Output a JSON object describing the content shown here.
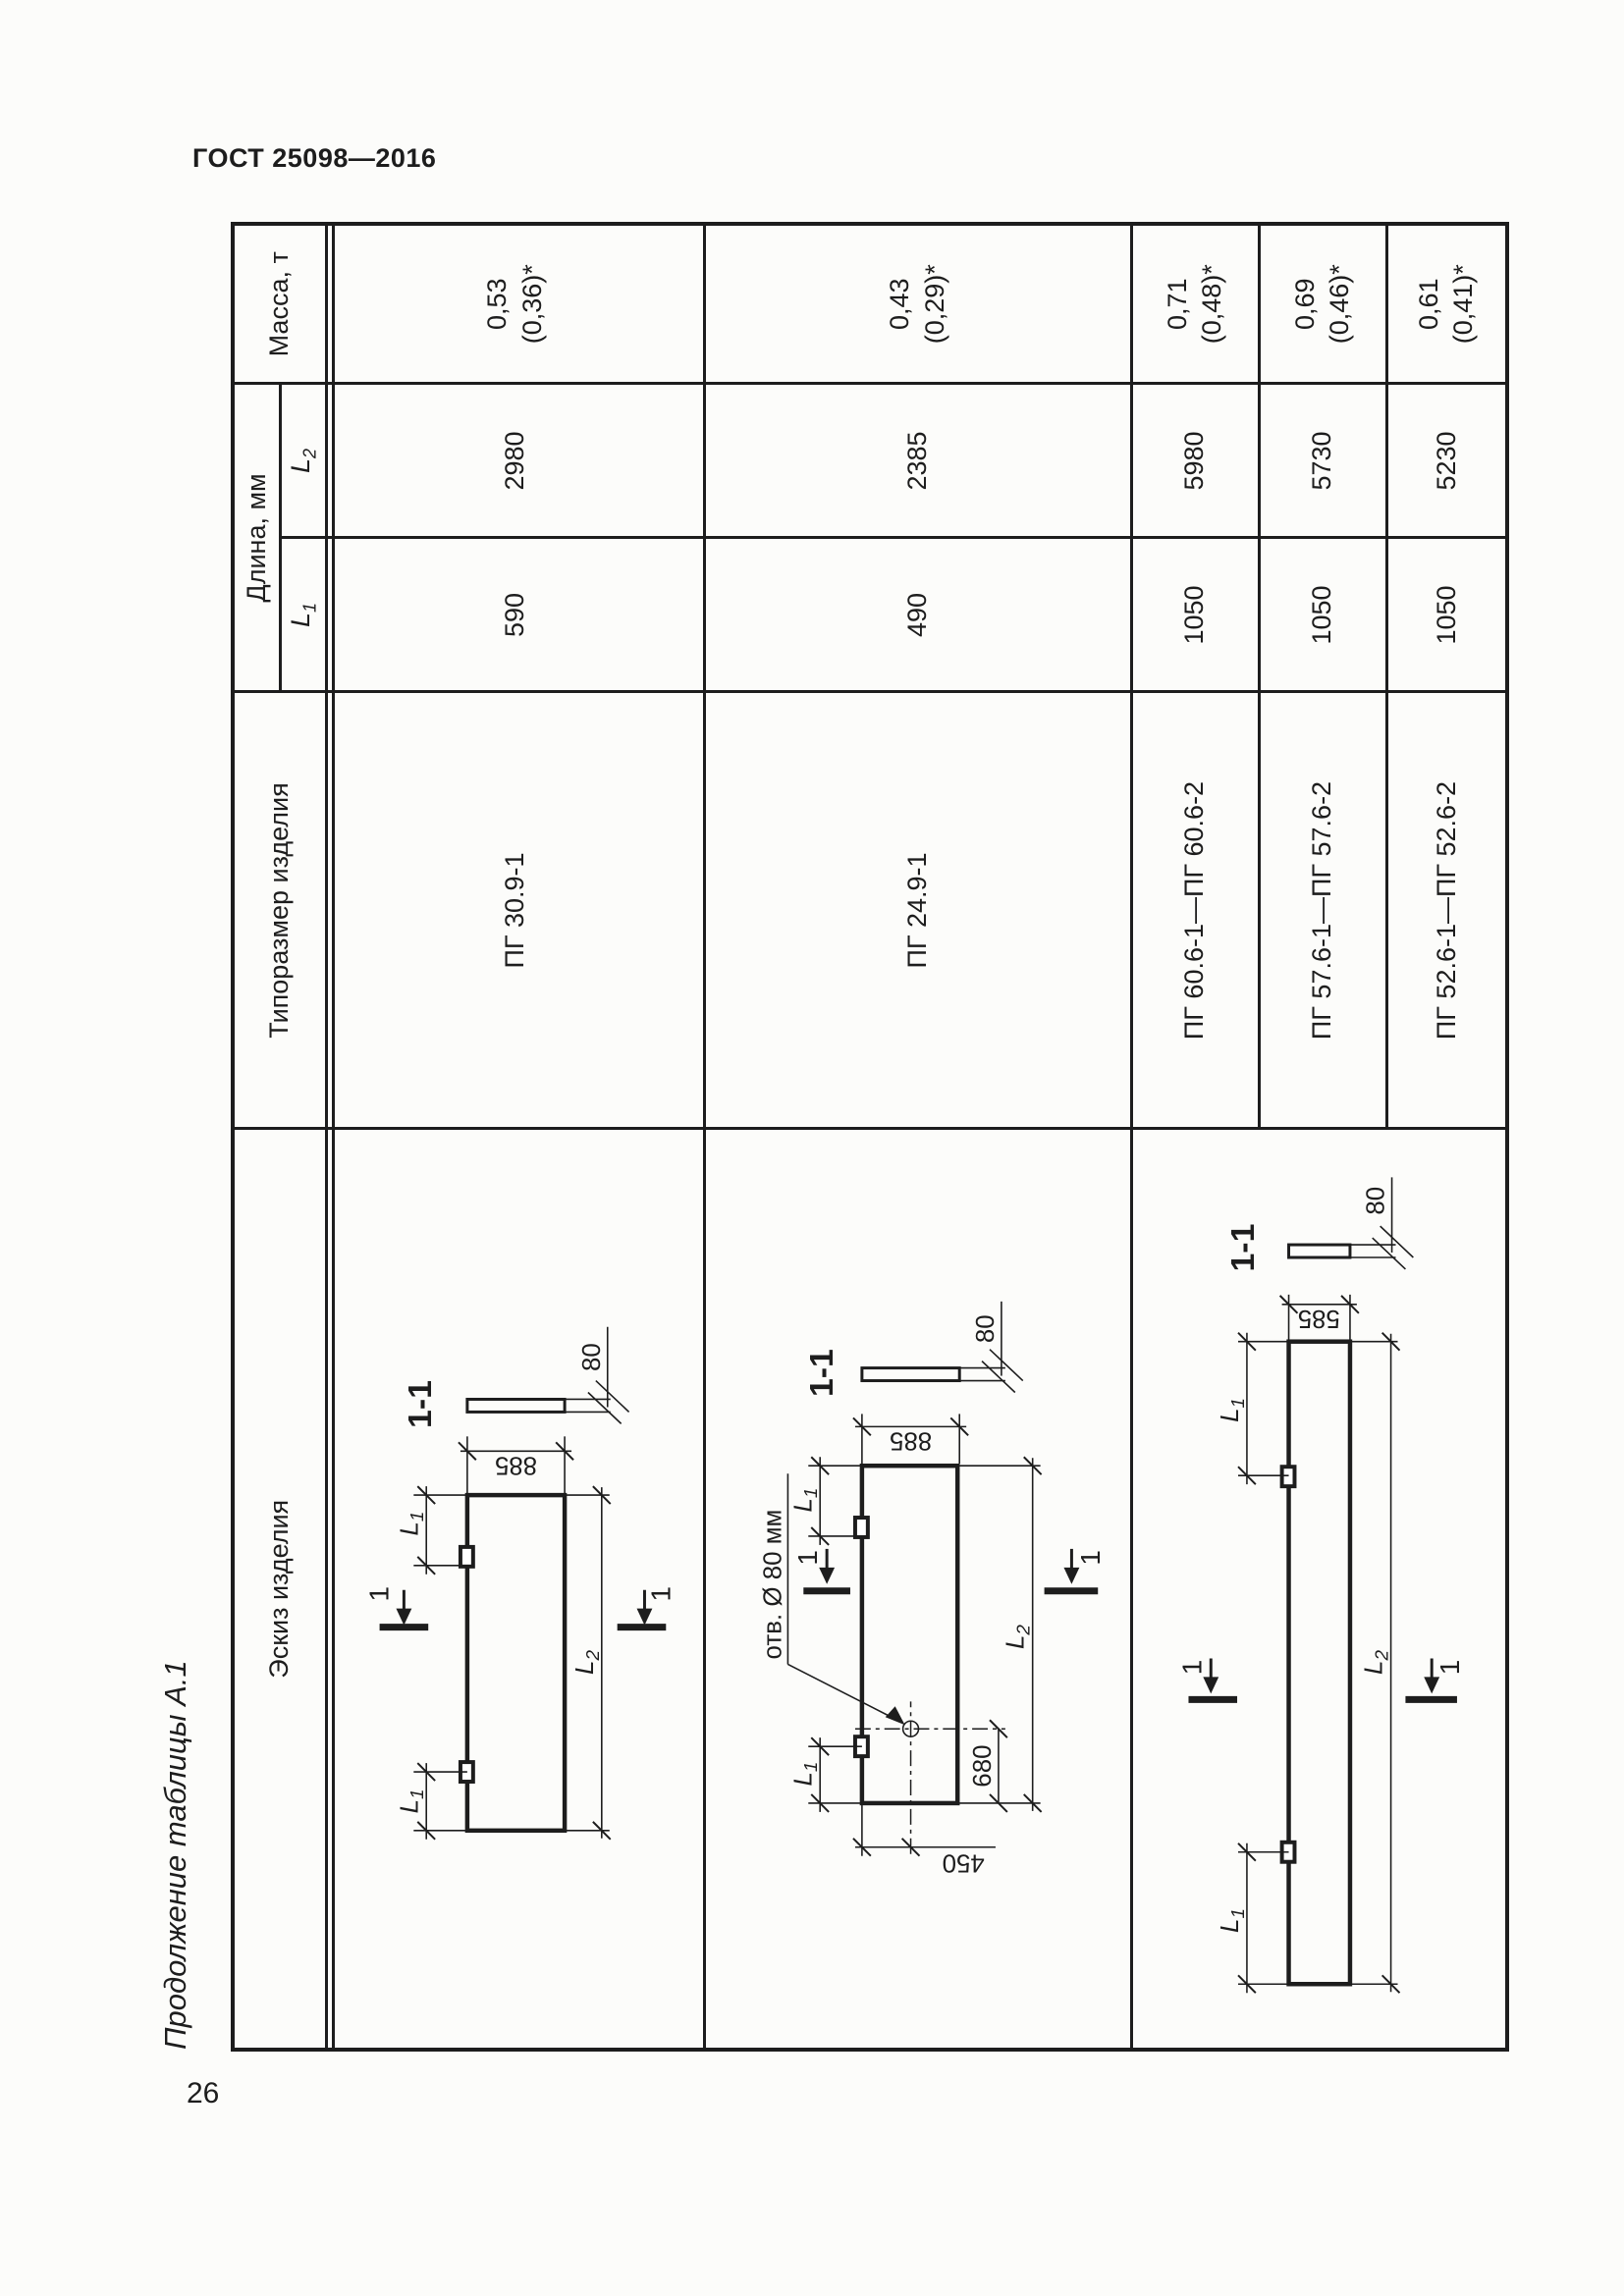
{
  "page": {
    "standard": "ГОСТ 25098—2016",
    "page_number": "26",
    "table_caption": "Продолжение таблицы А.1"
  },
  "table": {
    "headers": {
      "sketch": "Эскиз изделия",
      "type": "Типоразмер изделия",
      "length": "Длина, мм",
      "l1": {
        "base": "L",
        "sub": "1"
      },
      "l2": {
        "base": "L",
        "sub": "2"
      },
      "mass": "Масса, т"
    },
    "rows": [
      {
        "type": "ПГ 30.9-1",
        "l1": "590",
        "l2": "2980",
        "mass": "0,53",
        "mass_note": "(0,36)*"
      },
      {
        "type": "ПГ 24.9-1",
        "l1": "490",
        "l2": "2385",
        "mass": "0,43",
        "mass_note": "(0,29)*"
      },
      {
        "type": "ПГ 60.6-1—ПГ 60.6-2",
        "l1": "1050",
        "l2": "5980",
        "mass": "0,71",
        "mass_note": "(0,48)*"
      },
      {
        "type": "ПГ 57.6-1—ПГ 57.6-2",
        "l1": "1050",
        "l2": "5730",
        "mass": "0,69",
        "mass_note": "(0,46)*"
      },
      {
        "type": "ПГ 52.6-1—ПГ 52.6-2",
        "l1": "1050",
        "l2": "5230",
        "mass": "0,61",
        "mass_note": "(0,41)*"
      }
    ]
  },
  "sketch": {
    "section_title": "1-1",
    "cut_label": "1",
    "thickness": "80",
    "l1": {
      "base": "L",
      "sub": "1"
    },
    "l2": {
      "base": "L",
      "sub": "2"
    },
    "width_885": "885",
    "width_585": "585",
    "hole_note": "отв. Ø 80 мм",
    "hole_from_end": "680",
    "hole_from_edge": "450"
  }
}
